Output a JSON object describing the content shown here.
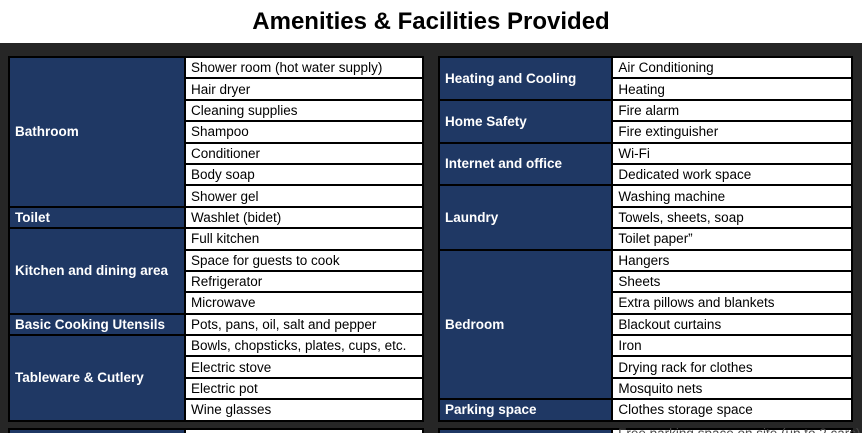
{
  "title": "Amenities & Facilities Provided",
  "colors": {
    "category_bg": "#1f3864",
    "category_text": "#ffffff",
    "frame_bg": "#262626",
    "cell_bg": "#ffffff",
    "cell_border": "#000000",
    "item_text": "#000000"
  },
  "left_table": {
    "sections": [
      {
        "category": "Bathroom",
        "items": [
          "Shower room (hot water supply)",
          "Hair dryer",
          "Cleaning supplies",
          "Shampoo",
          "Conditioner",
          "Body soap",
          "Shower gel"
        ]
      },
      {
        "category": "Toilet",
        "items": [
          "Washlet (bidet)"
        ]
      },
      {
        "category": "Kitchen and dining area",
        "items": [
          "Full kitchen",
          "Space for guests to cook",
          "Refrigerator",
          "Microwave"
        ]
      },
      {
        "category": "Basic Cooking Utensils",
        "items": [
          "Pots, pans, oil, salt and pepper"
        ]
      },
      {
        "category": "Tableware & Cutlery",
        "items": [
          "Bowls, chopsticks, plates, cups, etc.",
          "Electric stove",
          "Electric pot",
          "Wine glasses"
        ]
      }
    ]
  },
  "right_table": {
    "sections": [
      {
        "category": "Heating and Cooling",
        "items": [
          "Air Conditioning",
          "Heating"
        ]
      },
      {
        "category": "Home Safety",
        "items": [
          "Fire alarm",
          "Fire extinguisher"
        ]
      },
      {
        "category": "Internet and office",
        "items": [
          "Wi-Fi",
          "Dedicated work space"
        ]
      },
      {
        "category": "Laundry",
        "items": [
          "Washing machine",
          "Towels, sheets, soap",
          "Toilet paper”"
        ]
      },
      {
        "category": "Bedroom",
        "items": [
          "Hangers",
          "Sheets",
          "Extra pillows and blankets",
          "Blackout curtains",
          "Iron",
          "Drying rack for clothes",
          "Mosquito nets"
        ]
      },
      {
        "category": "Parking space",
        "items": [
          "Clothes storage space"
        ]
      }
    ]
  },
  "cutoff": {
    "left_item": "",
    "right_item": "Free parking space on site (up to 2 cars)"
  }
}
